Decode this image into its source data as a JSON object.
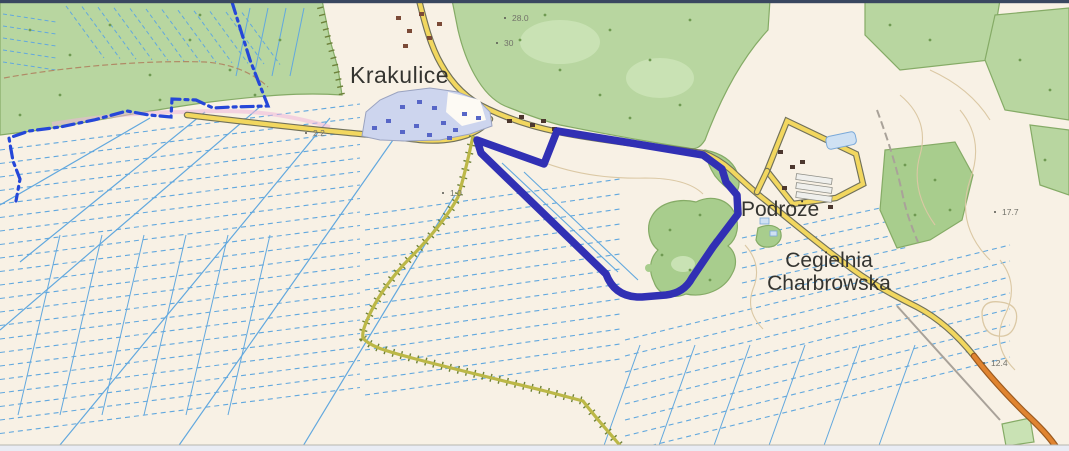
{
  "labels": {
    "krakulice": "Krakulice",
    "podroze": "Podroże",
    "cegielnia_line1": "Cegielnia",
    "cegielnia_line2": "Charbrowska"
  },
  "elevations": [
    {
      "t": "28.0",
      "x": 512,
      "y": 21
    },
    {
      "t": "30",
      "x": 504,
      "y": 46
    },
    {
      "t": "2.2",
      "x": 313,
      "y": 136
    },
    {
      "t": "1.0",
      "x": 450,
      "y": 196
    },
    {
      "t": "17.7",
      "x": 1002,
      "y": 215
    },
    {
      "t": "12.4",
      "x": 991,
      "y": 366
    }
  ],
  "colors": {
    "background": "#f8f1e5",
    "forest": "#b8d6a0",
    "forest_dark": "#a8cd8d",
    "forest_light": "#c9e2b4",
    "forest_edge": "#85ab66",
    "drain": "#62a8de",
    "boundary": "#2547d8",
    "parcel": "#3130b4",
    "road_yellow": "#f2d75f",
    "road_casing": "#71715a",
    "road_orange": "#e08430",
    "orange_casing": "#9a5a20",
    "avenue": "#bcb847",
    "avenue_tick": "#6d8039",
    "builtup": "#cdd5ee",
    "builtup_edge": "#9aa3c0",
    "building": "#5766c7",
    "building_brown": "#7b4a37",
    "building_dark": "#4c372e",
    "contour": "#dbc8a4",
    "track": "#a9a299",
    "path_brown": "#b08a66",
    "pink": "#efb6da",
    "pond_fill": "#cfe1f3",
    "pond_edge": "#7aa9d9",
    "greenhouse": "#efefec",
    "greenhouse_edge": "#8f8f88",
    "tree": "#6f9a52",
    "topbar": "#3a4760",
    "bottom_line": "#b6b6af",
    "bottombar": "#e9ecf4"
  }
}
